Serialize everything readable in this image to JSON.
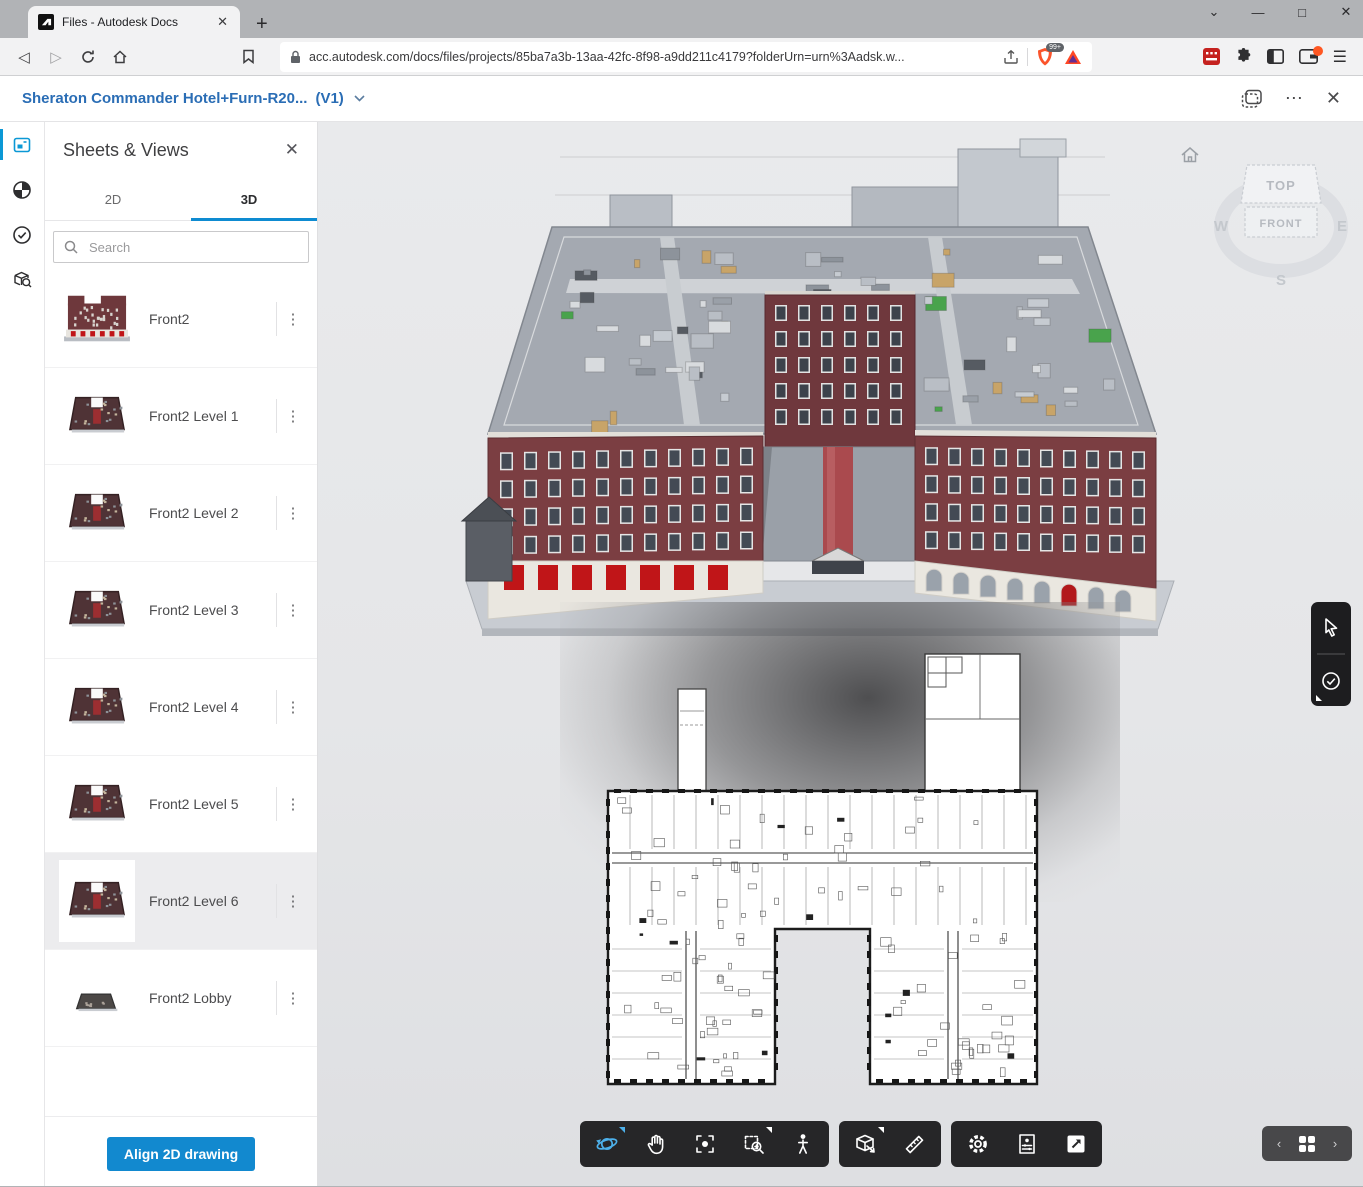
{
  "browser": {
    "tab_title": "Files - Autodesk Docs",
    "tab_close": "✕",
    "new_tab": "+",
    "url": "acc.autodesk.com/docs/files/projects/85ba7a3b-13aa-42fc-8f98-a9dd211c4179?folderUrn=urn%3Aadsk.w...",
    "shields_badge": "99+",
    "window_controls": {
      "menu": "⌄",
      "minimize": "—",
      "maximize": "□",
      "close": "✕"
    },
    "nav": {
      "back": "◁",
      "forward": "▷"
    }
  },
  "header": {
    "title": "Sheraton Commander Hotel+Furn-R20...",
    "version": "(V1)",
    "ellipsis": "⋯",
    "close": "✕"
  },
  "rail_icons": [
    "sheets-views",
    "appearance",
    "issues",
    "model-search"
  ],
  "panel": {
    "title": "Sheets & Views",
    "close": "✕",
    "tabs": [
      {
        "label": "2D",
        "active": false
      },
      {
        "label": "3D",
        "active": true
      }
    ],
    "search_placeholder": "Search",
    "items": [
      {
        "label": "Front2",
        "thumb": "elevation",
        "selected": false
      },
      {
        "label": "Front2 Level 1",
        "thumb": "plate",
        "selected": false
      },
      {
        "label": "Front2 Level 2",
        "thumb": "plate",
        "selected": false
      },
      {
        "label": "Front2 Level 3",
        "thumb": "plate",
        "selected": false
      },
      {
        "label": "Front2 Level 4",
        "thumb": "plate",
        "selected": false
      },
      {
        "label": "Front2 Level 5",
        "thumb": "plate",
        "selected": false
      },
      {
        "label": "Front2 Level 6",
        "thumb": "plate",
        "selected": true
      },
      {
        "label": "Front2 Lobby",
        "thumb": "plate-small",
        "selected": false
      }
    ],
    "align_button_label": "Align 2D drawing"
  },
  "viewport": {
    "viewcube": {
      "top": "TOP",
      "front": "FRONT",
      "west": "W",
      "east": "E",
      "south": "S"
    },
    "home_icon": "home",
    "right_toolbar_icons": [
      "cursor",
      "issues-check"
    ],
    "bottom_toolbar_groups": [
      {
        "icons": [
          {
            "name": "orbit",
            "active": true,
            "flyout": "blue"
          },
          {
            "name": "pan"
          },
          {
            "name": "fit-to-view"
          },
          {
            "name": "zoom-window",
            "flyout": "white"
          },
          {
            "name": "first-person"
          }
        ]
      },
      {
        "icons": [
          {
            "name": "section-analysis",
            "flyout": "white"
          },
          {
            "name": "measure"
          }
        ]
      },
      {
        "icons": [
          {
            "name": "settings"
          },
          {
            "name": "document-views"
          },
          {
            "name": "fullscreen"
          }
        ]
      }
    ],
    "pager": {
      "prev": "‹",
      "next": "›",
      "grid_icon": "views-grid"
    }
  },
  "colors": {
    "accent_blue": "#0e8bd1",
    "title_blue": "#2a6db5",
    "button_blue": "#1289cf",
    "toolbar_dark": "#262628",
    "brick": "#7b3e42",
    "viewport_bg": "#e7e8ea",
    "awning_red": "#c01518"
  }
}
